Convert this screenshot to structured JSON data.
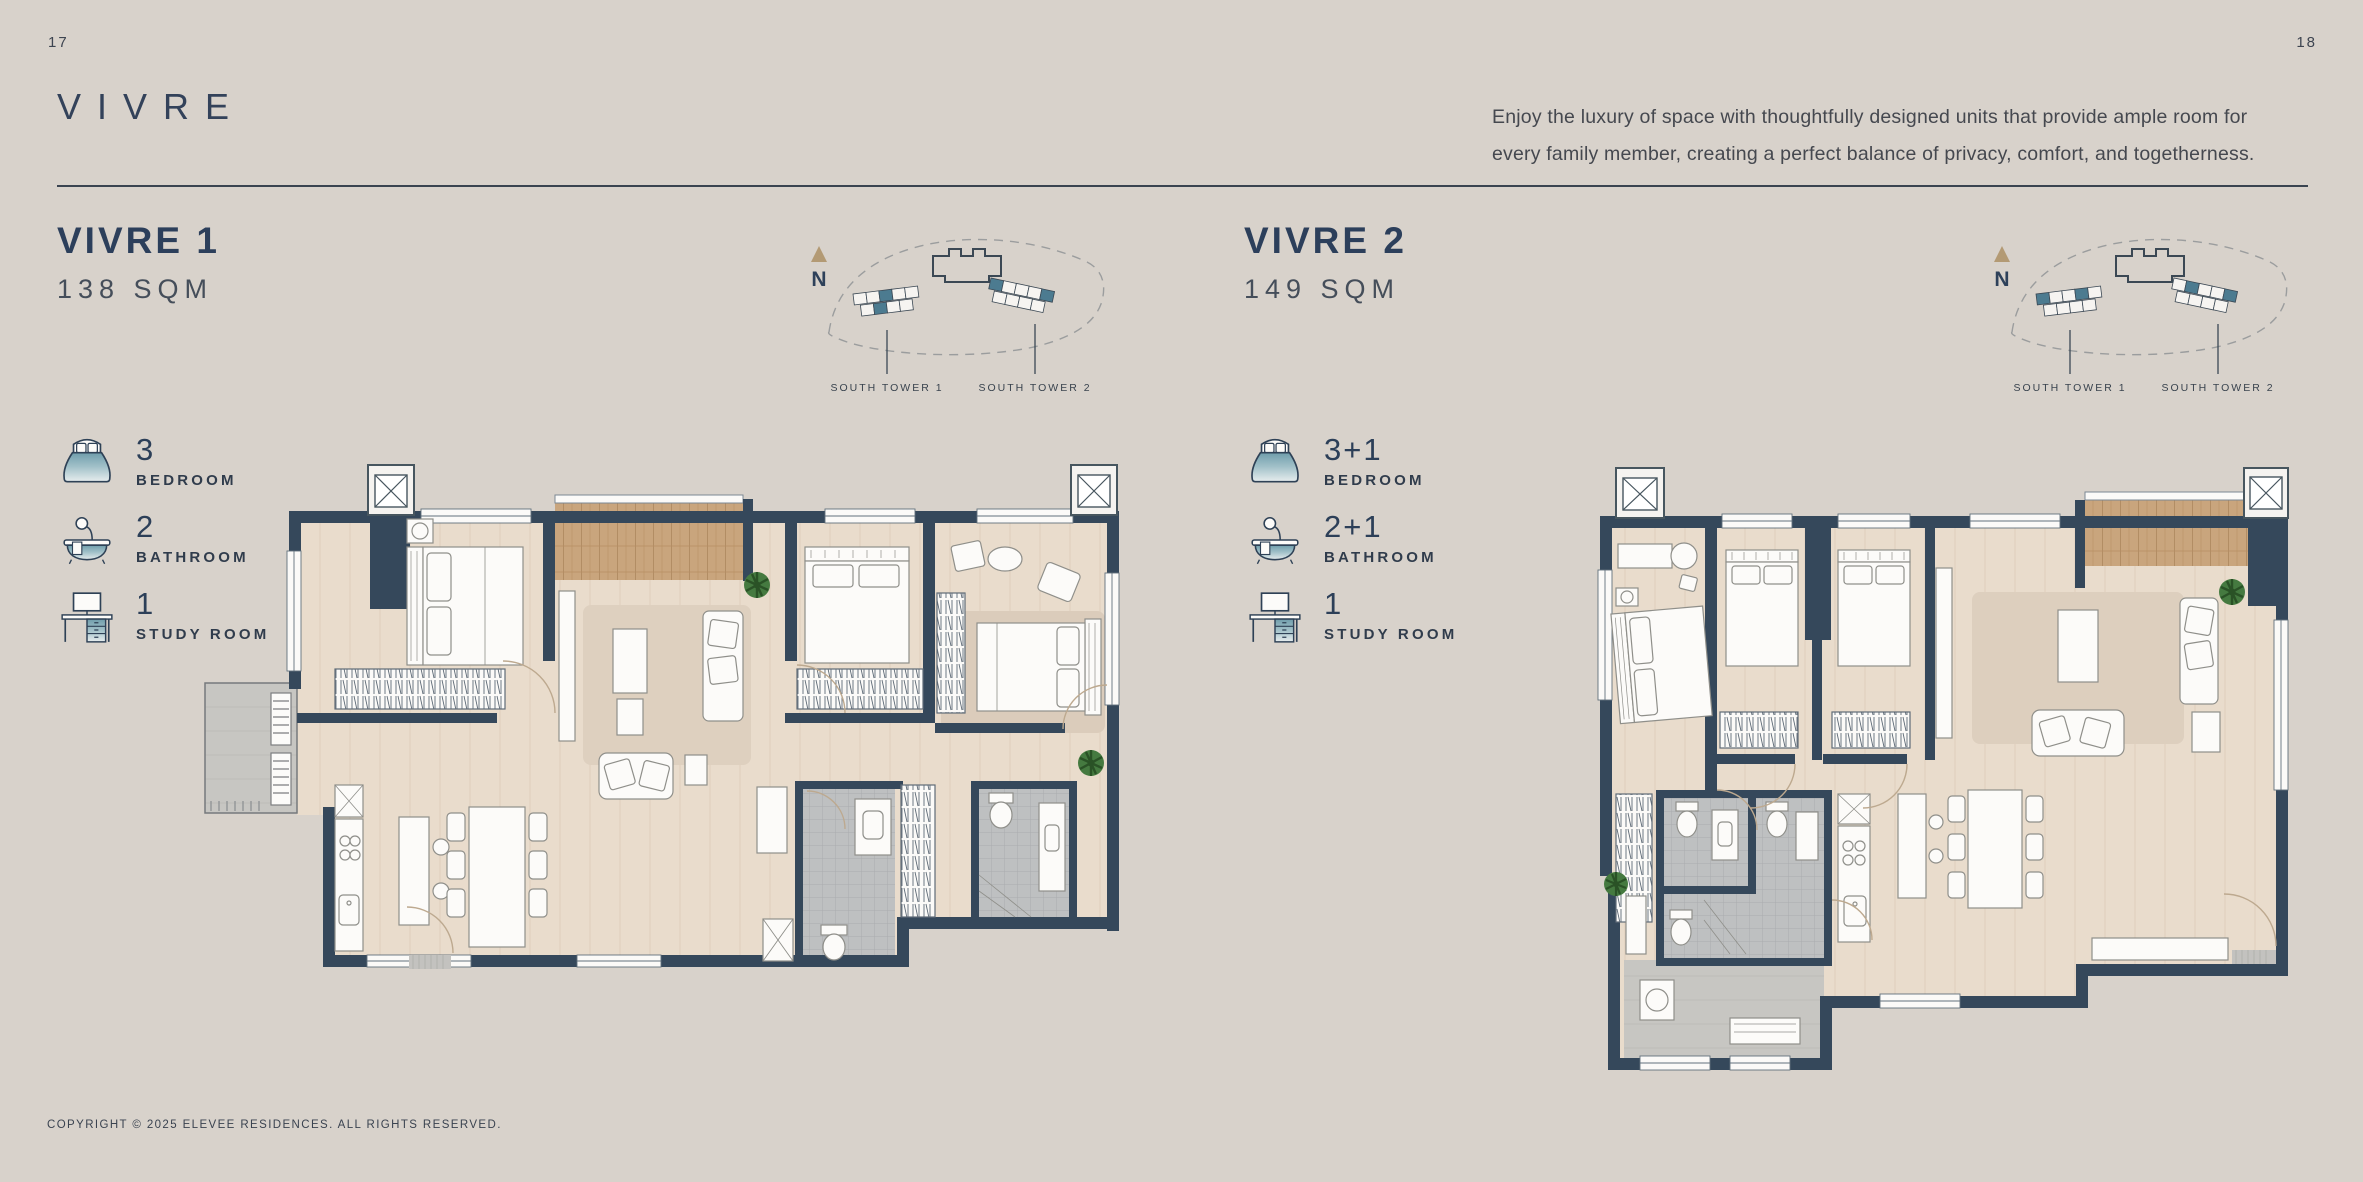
{
  "page": {
    "number_left": "17",
    "number_right": "18",
    "title": "VIVRE",
    "description_line1": "Enjoy the luxury of space with thoughtfully designed units that provide ample room for",
    "description_line2": "every family member, creating a perfect balance of privacy, comfort, and togetherness.",
    "copyright": "COPYRIGHT © 2025 ELEVEE RESIDENCES. ALL RIGHTS RESERVED."
  },
  "colors": {
    "background": "#d8d2cb",
    "heading_navy": "#2c3f5b",
    "body_text": "#45484f",
    "wall": "#35485b",
    "floor": "#e9dccc",
    "balcony_wood": "#c9a57d",
    "wet_area_grey": "#bec0c1",
    "unit_highlight_teal": "#4c7b90",
    "compass_tan": "#b39a74",
    "plant_green": "#457a40"
  },
  "units": [
    {
      "name": "VIVRE 1",
      "area": "138 SQM",
      "specs": [
        {
          "icon": "bed-icon",
          "value": "3",
          "label": "BEDROOM"
        },
        {
          "icon": "bathtub-icon",
          "value": "2",
          "label": "BATHROOM"
        },
        {
          "icon": "desk-icon",
          "value": "1",
          "label": "STUDY ROOM"
        }
      ],
      "site_plan": {
        "compass": "N",
        "tower_1_label": "SOUTH TOWER 1",
        "tower_2_label": "SOUTH TOWER 2"
      }
    },
    {
      "name": "VIVRE 2",
      "area": "149 SQM",
      "specs": [
        {
          "icon": "bed-icon",
          "value": "3+1",
          "label": "BEDROOM"
        },
        {
          "icon": "bathtub-icon",
          "value": "2+1",
          "label": "BATHROOM"
        },
        {
          "icon": "desk-icon",
          "value": "1",
          "label": "STUDY ROOM"
        }
      ],
      "site_plan": {
        "compass": "N",
        "tower_1_label": "SOUTH TOWER 1",
        "tower_2_label": "SOUTH TOWER 2"
      }
    }
  ]
}
